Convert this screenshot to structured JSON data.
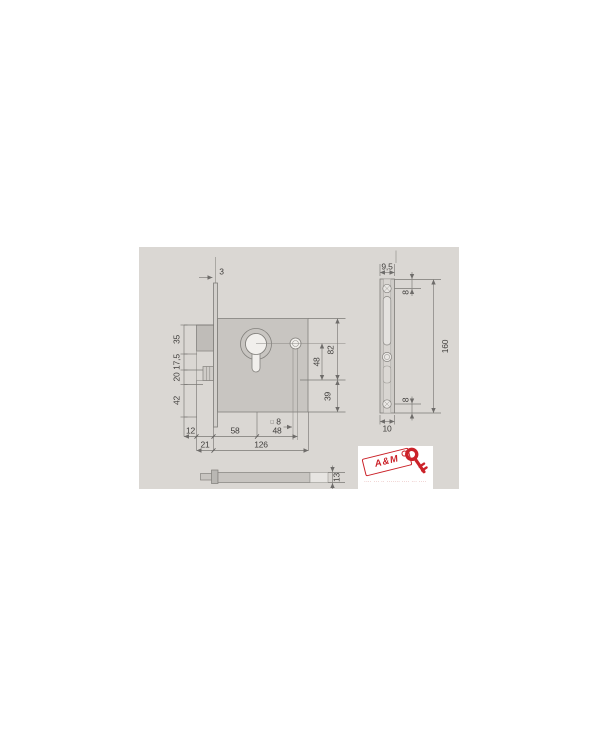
{
  "colors": {
    "page_background": "#ffffff",
    "panel_background": "#dad7d3",
    "lock_body_fill": "#c8c5c1",
    "drawing_line": "#7a7875",
    "label_text": "#413f3d",
    "logo_red": "#cb2229"
  },
  "front": {
    "d3": "3",
    "d35": "35",
    "d17_5": "17,5",
    "d20": "20",
    "d42": "42",
    "d82": "82",
    "d48v": "48",
    "d39": "39",
    "sq": "□",
    "d8sq": "8",
    "d12": "12",
    "d58": "58",
    "d48h": "48",
    "d21": "21",
    "d126": "126"
  },
  "side": {
    "d9_5": "9,5",
    "d8t": "8",
    "d160": "160",
    "d8b": "8",
    "d10": "10"
  },
  "top": {
    "d13": "13"
  },
  "logo": {
    "brand": "A&M",
    "tagline": "···· ··· ·· ······· ···· ··· ····"
  }
}
